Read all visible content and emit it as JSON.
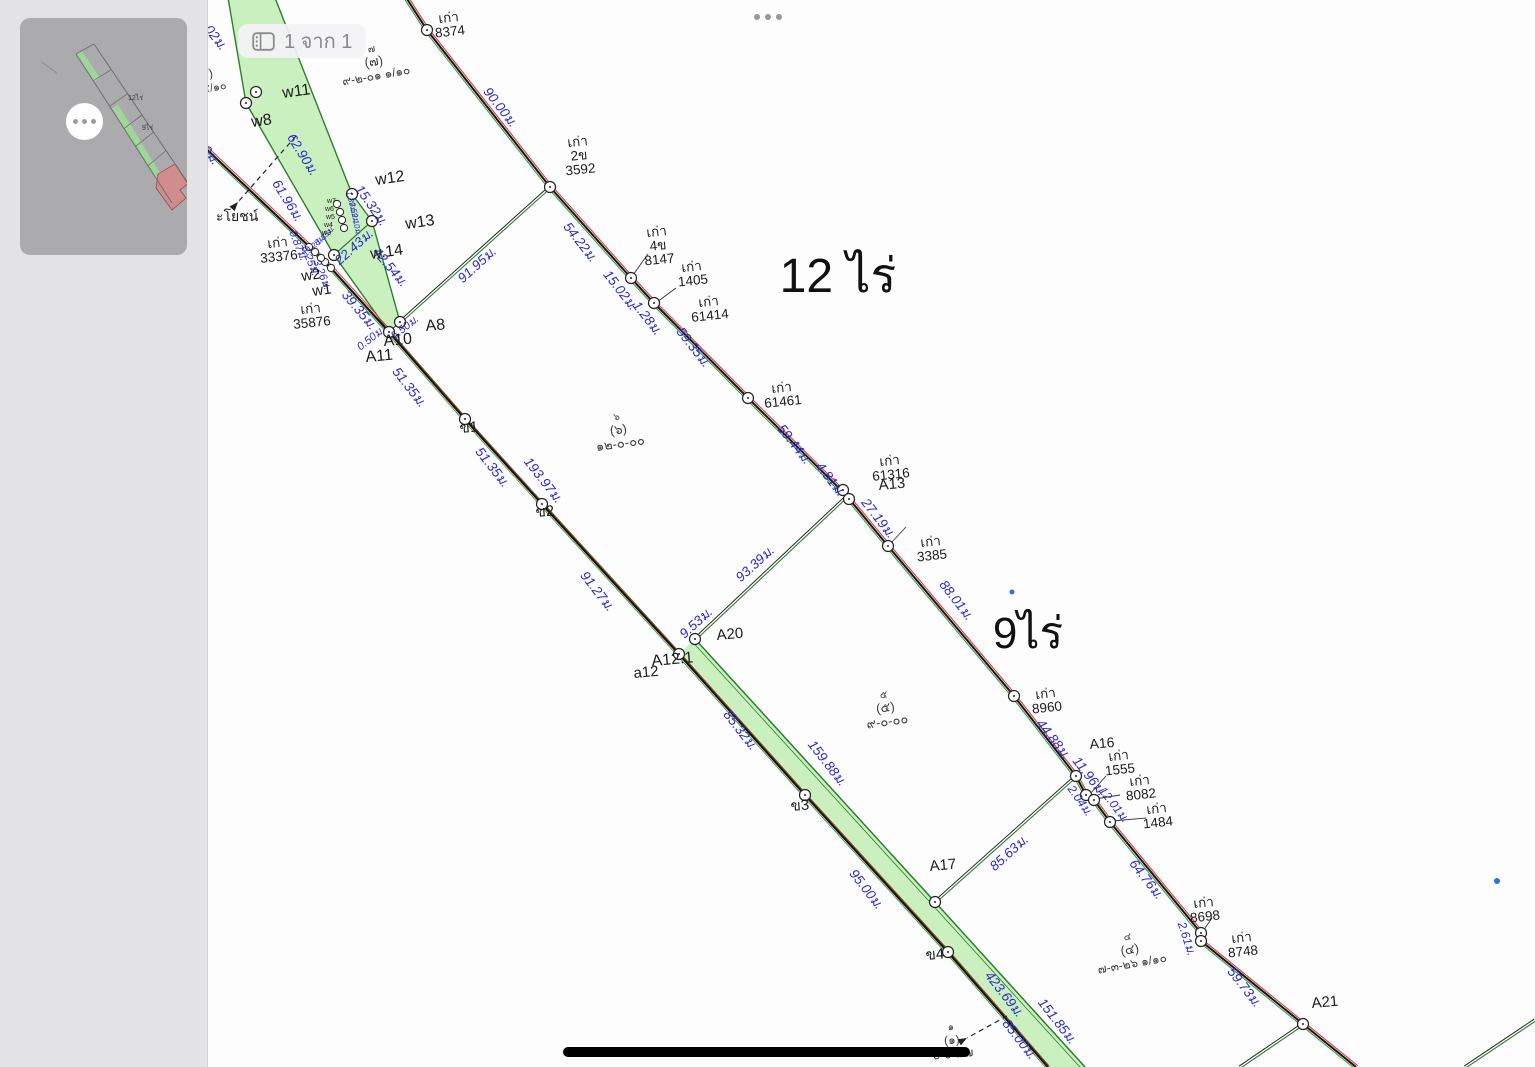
{
  "toolbar": {
    "page_indicator": "1 จาก 1"
  },
  "sidebar": {
    "thumbnail_labels": {
      "large": "12ไร่",
      "small": "9ไร่"
    }
  },
  "map": {
    "colors": {
      "strip_fill": "#cbf0bf",
      "strip_edge": "#2e7d32",
      "green_line": "#3a9d46",
      "red_line": "#e03a3a",
      "black_line": "#161616",
      "brown_line": "#8a4a2c",
      "measure_text": "#2a2ac8",
      "label_text": "#1b1b1b",
      "parcel_text": "#3f3f3f",
      "blue_dot": "#2f6fed"
    },
    "area_labels": [
      {
        "text": "12 ไร่",
        "x": 838,
        "y": 292,
        "s": 48
      },
      {
        "text": "9ไร่",
        "x": 1028,
        "y": 648,
        "s": 44
      }
    ],
    "parcel_labels": [
      {
        "lines": [
          "๗",
          "(๗)",
          "๙-๒-๐๑ ๑/๑๐"
        ],
        "x": 372,
        "y": 52,
        "r": -10,
        "sz": [
          10,
          13,
          12
        ]
      },
      {
        "lines": [
          "๕)",
          "๓ ๕/๑๐"
        ],
        "x": 207,
        "y": 78,
        "r": -10,
        "sz": [
          12,
          11
        ]
      },
      {
        "lines": [
          "๖",
          "(๖)",
          "๑๒-๐-๐๐"
        ],
        "x": 617,
        "y": 420,
        "r": -8,
        "sz": [
          10,
          13,
          13
        ]
      },
      {
        "lines": [
          "๕",
          "(๕)",
          "๙-๐-๐๐"
        ],
        "x": 884,
        "y": 698,
        "r": -8,
        "sz": [
          10,
          13,
          13
        ]
      },
      {
        "lines": [
          "๔",
          "(๔)",
          "๗-๓-๒๖ ๑/๑๐"
        ],
        "x": 1128,
        "y": 940,
        "r": -10,
        "sz": [
          10,
          13,
          12
        ]
      },
      {
        "lines": [
          "๑",
          "(๑)",
          "๐-๐-๙๗"
        ],
        "x": 951,
        "y": 1030,
        "r": -5,
        "sz": [
          10,
          12,
          12
        ]
      }
    ],
    "point_labels": [
      {
        "t": "w11",
        "x": 283,
        "y": 98,
        "r": -8,
        "s": 16
      },
      {
        "t": "w8",
        "x": 252,
        "y": 127,
        "r": -8,
        "s": 16
      },
      {
        "t": "w12",
        "x": 376,
        "y": 185,
        "r": -8,
        "s": 16
      },
      {
        "t": "w13",
        "x": 406,
        "y": 229,
        "r": -8,
        "s": 16
      },
      {
        "t": "w.14",
        "x": 371,
        "y": 259,
        "r": -8,
        "s": 16
      },
      {
        "t": "w2",
        "x": 302,
        "y": 281,
        "r": -8,
        "s": 15
      },
      {
        "t": "w1",
        "x": 313,
        "y": 296,
        "r": -8,
        "s": 15
      },
      {
        "t": "w7",
        "x": 327,
        "y": 203,
        "r": 0,
        "s": 7
      },
      {
        "t": "w6",
        "x": 325,
        "y": 211,
        "r": 0,
        "s": 7
      },
      {
        "t": "w5",
        "x": 326,
        "y": 219,
        "r": 0,
        "s": 7
      },
      {
        "t": "w4",
        "x": 324,
        "y": 227,
        "r": 0,
        "s": 7
      },
      {
        "t": "w3",
        "x": 322,
        "y": 235,
        "r": 0,
        "s": 7
      },
      {
        "t": "A8",
        "x": 426,
        "y": 331,
        "r": -5,
        "s": 16
      },
      {
        "t": "A10",
        "x": 384,
        "y": 346,
        "r": -5,
        "s": 16
      },
      {
        "t": "A11",
        "x": 366,
        "y": 362,
        "r": -5,
        "s": 16
      },
      {
        "t": "ข1",
        "x": 460,
        "y": 433,
        "r": -5,
        "s": 15
      },
      {
        "t": "ข2",
        "x": 536,
        "y": 517,
        "r": -5,
        "s": 15
      },
      {
        "t": "ข3",
        "x": 791,
        "y": 811,
        "r": -5,
        "s": 15
      },
      {
        "t": "ข4",
        "x": 926,
        "y": 960,
        "r": -5,
        "s": 15
      },
      {
        "t": "A12.1",
        "x": 652,
        "y": 666,
        "r": -5,
        "s": 16
      },
      {
        "t": "a12",
        "x": 634,
        "y": 678,
        "r": -5,
        "s": 15
      },
      {
        "t": "A20",
        "x": 717,
        "y": 640,
        "r": -5,
        "s": 15
      },
      {
        "t": "A13",
        "x": 879,
        "y": 490,
        "r": -5,
        "s": 15
      },
      {
        "t": "A16",
        "x": 1090,
        "y": 749,
        "r": -5,
        "s": 14
      },
      {
        "t": "A17",
        "x": 930,
        "y": 871,
        "r": -5,
        "s": 15
      },
      {
        "t": "A21",
        "x": 1312,
        "y": 1008,
        "r": -5,
        "s": 15
      },
      {
        "t": "ะโยชน์",
        "x": 216,
        "y": 221,
        "r": 0,
        "s": 14
      }
    ],
    "marker_labels": [
      {
        "lines": [
          "เก่า",
          "8374"
        ],
        "x": 449,
        "y": 22,
        "r": -6
      },
      {
        "lines": [
          "เก่า",
          "2ข",
          "3592"
        ],
        "x": 578,
        "y": 146,
        "r": -6
      },
      {
        "lines": [
          "เก่า",
          "4ข",
          "8147"
        ],
        "x": 657,
        "y": 236,
        "r": -6
      },
      {
        "lines": [
          "เก่า",
          "1405"
        ],
        "x": 692,
        "y": 271,
        "r": -6
      },
      {
        "lines": [
          "เก่า",
          "61414"
        ],
        "x": 709,
        "y": 306,
        "r": -6
      },
      {
        "lines": [
          "เก่า",
          "61461"
        ],
        "x": 782,
        "y": 392,
        "r": -6
      },
      {
        "lines": [
          "เก่า",
          "61316"
        ],
        "x": 890,
        "y": 465,
        "r": -6
      },
      {
        "lines": [
          "เก่า",
          "3385"
        ],
        "x": 931,
        "y": 546,
        "r": -6
      },
      {
        "lines": [
          "เก่า",
          "33376"
        ],
        "x": 278,
        "y": 247,
        "r": -6
      },
      {
        "lines": [
          "เก่า",
          "35876"
        ],
        "x": 311,
        "y": 313,
        "r": -6
      },
      {
        "lines": [
          "เก่า",
          "8960"
        ],
        "x": 1046,
        "y": 698,
        "r": -6
      },
      {
        "lines": [
          "เก่า",
          "1555"
        ],
        "x": 1119,
        "y": 760,
        "r": -6
      },
      {
        "lines": [
          "เก่า",
          "8082"
        ],
        "x": 1140,
        "y": 785,
        "r": -6
      },
      {
        "lines": [
          "เก่า",
          "1484"
        ],
        "x": 1157,
        "y": 813,
        "r": -6
      },
      {
        "lines": [
          "เก่า",
          "8698"
        ],
        "x": 1204,
        "y": 907,
        "r": -6
      },
      {
        "lines": [
          "เก่า",
          "8748"
        ],
        "x": 1242,
        "y": 942,
        "r": -6
      }
    ],
    "measurements": [
      {
        "t": "3.02ม.",
        "x": 209,
        "y": 36,
        "r": 52
      },
      {
        "t": "62.90ม.",
        "x": 299,
        "y": 157,
        "r": 58
      },
      {
        "t": "61.96ม.",
        "x": 284,
        "y": 203,
        "r": 58
      },
      {
        "t": "49ม.",
        "x": 205,
        "y": 155,
        "r": 52
      },
      {
        "t": "90.00ม.",
        "x": 497,
        "y": 110,
        "r": 52
      },
      {
        "t": "54.22ม.",
        "x": 577,
        "y": 245,
        "r": 52
      },
      {
        "t": "91.95ม.",
        "x": 480,
        "y": 268,
        "r": -42
      },
      {
        "t": "15.32ม.",
        "x": 368,
        "y": 208,
        "r": 55
      },
      {
        "t": "22.43ม.",
        "x": 357,
        "y": 250,
        "r": -42
      },
      {
        "t": "42.54ม.",
        "x": 387,
        "y": 270,
        "r": 50
      },
      {
        "t": "39.35ม.",
        "x": 356,
        "y": 313,
        "r": 50
      },
      {
        "t": "0.87ม.",
        "x": 295,
        "y": 247,
        "r": 68,
        "s": 11
      },
      {
        "t": "6.25ม.",
        "x": 307,
        "y": 262,
        "r": 68,
        "s": 11
      },
      {
        "t": "3.26ม.",
        "x": 319,
        "y": 276,
        "r": 68,
        "s": 11
      },
      {
        "t": "0.50ม.",
        "x": 373,
        "y": 341,
        "r": -38,
        "s": 11
      },
      {
        "t": "5.50ม.",
        "x": 407,
        "y": 330,
        "r": -38,
        "s": 11
      },
      {
        "t": "1.39ม.",
        "x": 349,
        "y": 203,
        "r": 78,
        "s": 8
      },
      {
        "t": "3.59ม.",
        "x": 352,
        "y": 214,
        "r": 78,
        "s": 8
      },
      {
        "t": "2.10ม.",
        "x": 354,
        "y": 225,
        "r": 78,
        "s": 8
      },
      {
        "t": "15.28ม.",
        "x": 316,
        "y": 247,
        "r": -45,
        "s": 8
      },
      {
        "t": "1.35ม.",
        "x": 327,
        "y": 237,
        "r": -45,
        "s": 8
      },
      {
        "t": "51.35ม.",
        "x": 406,
        "y": 390,
        "r": 52
      },
      {
        "t": "51.35ม.",
        "x": 489,
        "y": 470,
        "r": 52
      },
      {
        "t": "193.97ม.",
        "x": 540,
        "y": 483,
        "r": 52
      },
      {
        "t": "91.27ม.",
        "x": 594,
        "y": 594,
        "r": 52
      },
      {
        "t": "15.02ม.",
        "x": 617,
        "y": 293,
        "r": 52
      },
      {
        "t": "1.28ม.",
        "x": 644,
        "y": 321,
        "r": 52
      },
      {
        "t": "59.35ม.",
        "x": 690,
        "y": 350,
        "r": 52
      },
      {
        "t": "59.44ม.",
        "x": 791,
        "y": 447,
        "r": 52
      },
      {
        "t": "4.81ม.",
        "x": 827,
        "y": 482,
        "r": 52
      },
      {
        "t": "27.19ม.",
        "x": 875,
        "y": 521,
        "r": 52
      },
      {
        "t": "93.39ม.",
        "x": 758,
        "y": 567,
        "r": -42
      },
      {
        "t": "9.53ม.",
        "x": 699,
        "y": 626,
        "r": -42
      },
      {
        "t": "88.01ม.",
        "x": 953,
        "y": 603,
        "r": 52
      },
      {
        "t": "44.88ม.",
        "x": 1050,
        "y": 742,
        "r": 52
      },
      {
        "t": "11.96ม.",
        "x": 1086,
        "y": 779,
        "r": 52
      },
      {
        "t": "2.04ม.",
        "x": 1077,
        "y": 803,
        "r": 55,
        "s": 12
      },
      {
        "t": "12.01ม.",
        "x": 1111,
        "y": 807,
        "r": 52,
        "s": 12
      },
      {
        "t": "85.32ม.",
        "x": 737,
        "y": 733,
        "r": 52
      },
      {
        "t": "159.88ม.",
        "x": 824,
        "y": 766,
        "r": 52
      },
      {
        "t": "95.00ม.",
        "x": 863,
        "y": 892,
        "r": 52
      },
      {
        "t": "85.63ม.",
        "x": 1012,
        "y": 856,
        "r": -42
      },
      {
        "t": "64.76ม.",
        "x": 1143,
        "y": 882,
        "r": 52
      },
      {
        "t": "2.61ม.",
        "x": 1183,
        "y": 940,
        "r": 72,
        "s": 12
      },
      {
        "t": "59.73ม.",
        "x": 1241,
        "y": 990,
        "r": 52
      },
      {
        "t": "423.69ม.",
        "x": 1001,
        "y": 997,
        "r": 52
      },
      {
        "t": "151.85ม.",
        "x": 1054,
        "y": 1024,
        "r": 52
      },
      {
        "t": "85.00ม.",
        "x": 1016,
        "y": 1042,
        "r": 52
      }
    ],
    "geometry": {
      "strip1": [
        [
          225,
          -20
        ],
        [
          268,
          -20
        ],
        [
          352,
          194
        ],
        [
          372,
          221
        ],
        [
          400,
          322
        ],
        [
          389,
          332
        ],
        [
          334,
          255
        ],
        [
          246,
          103
        ]
      ],
      "strip1_inner": [
        [
          334,
          255
        ],
        [
          372,
          221
        ]
      ],
      "strip2": [
        [
          679,
          654
        ],
        [
          695,
          639
        ],
        [
          1085,
          1067
        ],
        [
          1048,
          1067
        ]
      ],
      "strip2_edge": [
        [
          695,
          639
        ],
        [
          935,
          902
        ],
        [
          1085,
          1067
        ]
      ],
      "boundary": [
        [
          398,
          -15
        ],
        [
          427,
          30
        ],
        [
          550,
          187
        ],
        [
          631,
          278
        ],
        [
          654,
          303
        ],
        [
          748,
          398
        ],
        [
          846,
          495
        ],
        [
          888,
          546
        ],
        [
          1014,
          696
        ],
        [
          1076,
          776
        ],
        [
          1086,
          795
        ],
        [
          1094,
          800
        ],
        [
          1110,
          822
        ],
        [
          1201,
          933
        ],
        [
          1201,
          941
        ],
        [
          1303,
          1024
        ],
        [
          1356,
          1067
        ]
      ],
      "road1": [
        [
          200,
          143
        ],
        [
          315,
          252
        ],
        [
          330,
          267
        ],
        [
          389,
          332
        ]
      ],
      "road2": [
        [
          389,
          332
        ],
        [
          465,
          419
        ],
        [
          542,
          504
        ],
        [
          679,
          654
        ],
        [
          805,
          795
        ],
        [
          948,
          952
        ],
        [
          1048,
          1067
        ]
      ],
      "cross": [
        [
          [
            400,
            322
          ],
          [
            550,
            187
          ]
        ],
        [
          [
            695,
            639
          ],
          [
            846,
            497
          ]
        ],
        [
          [
            935,
            902
          ],
          [
            1076,
            776
          ]
        ],
        [
          [
            1303,
            1024
          ],
          [
            1240,
            1067
          ]
        ],
        [
          [
            1535,
            1020
          ],
          [
            1465,
            1067
          ]
        ]
      ],
      "leaders": [
        [
          648,
          254,
          633,
          275
        ],
        [
          676,
          288,
          657,
          302
        ],
        [
          906,
          527,
          890,
          544
        ],
        [
          1106,
          776,
          1090,
          794
        ],
        [
          1120,
          795,
          1095,
          799
        ],
        [
          1146,
          818,
          1112,
          821
        ],
        [
          1212,
          918,
          1203,
          931
        ]
      ],
      "dashed_arrows": [
        {
          "pts": [
            [
              296,
              136
            ],
            [
              238,
              202
            ]
          ]
        },
        {
          "pts": [
            [
              1007,
              1016
            ],
            [
              967,
              1038
            ]
          ]
        }
      ],
      "circles": [
        [
          427,
          30
        ],
        [
          550,
          187
        ],
        [
          631,
          278
        ],
        [
          654,
          303
        ],
        [
          748,
          398
        ],
        [
          843,
          490
        ],
        [
          849,
          499
        ],
        [
          888,
          546
        ],
        [
          1014,
          696
        ],
        [
          1076,
          776
        ],
        [
          1086,
          795
        ],
        [
          1094,
          800
        ],
        [
          1110,
          822
        ],
        [
          1201,
          933
        ],
        [
          1201,
          941
        ],
        [
          1303,
          1024
        ],
        [
          400,
          322
        ],
        [
          389,
          332
        ],
        [
          465,
          419
        ],
        [
          542,
          504
        ],
        [
          679,
          654
        ],
        [
          695,
          639
        ],
        [
          805,
          795
        ],
        [
          935,
          902
        ],
        [
          948,
          952
        ],
        [
          256,
          92
        ],
        [
          246,
          103
        ],
        [
          352,
          194
        ],
        [
          372,
          221
        ],
        [
          334,
          255
        ]
      ],
      "small_circles": [
        [
          337,
          204
        ],
        [
          340,
          212
        ],
        [
          342,
          220
        ],
        [
          344,
          228
        ],
        [
          325,
          262
        ],
        [
          331,
          268
        ],
        [
          315,
          252
        ],
        [
          309,
          247
        ],
        [
          321,
          258
        ]
      ],
      "blue_dots": [
        [
          1012,
          592,
          2.5
        ],
        [
          1497,
          881,
          3
        ]
      ],
      "scale_bar": {
        "x": 563,
        "y": 1047,
        "w": 407,
        "h": 10
      }
    }
  }
}
